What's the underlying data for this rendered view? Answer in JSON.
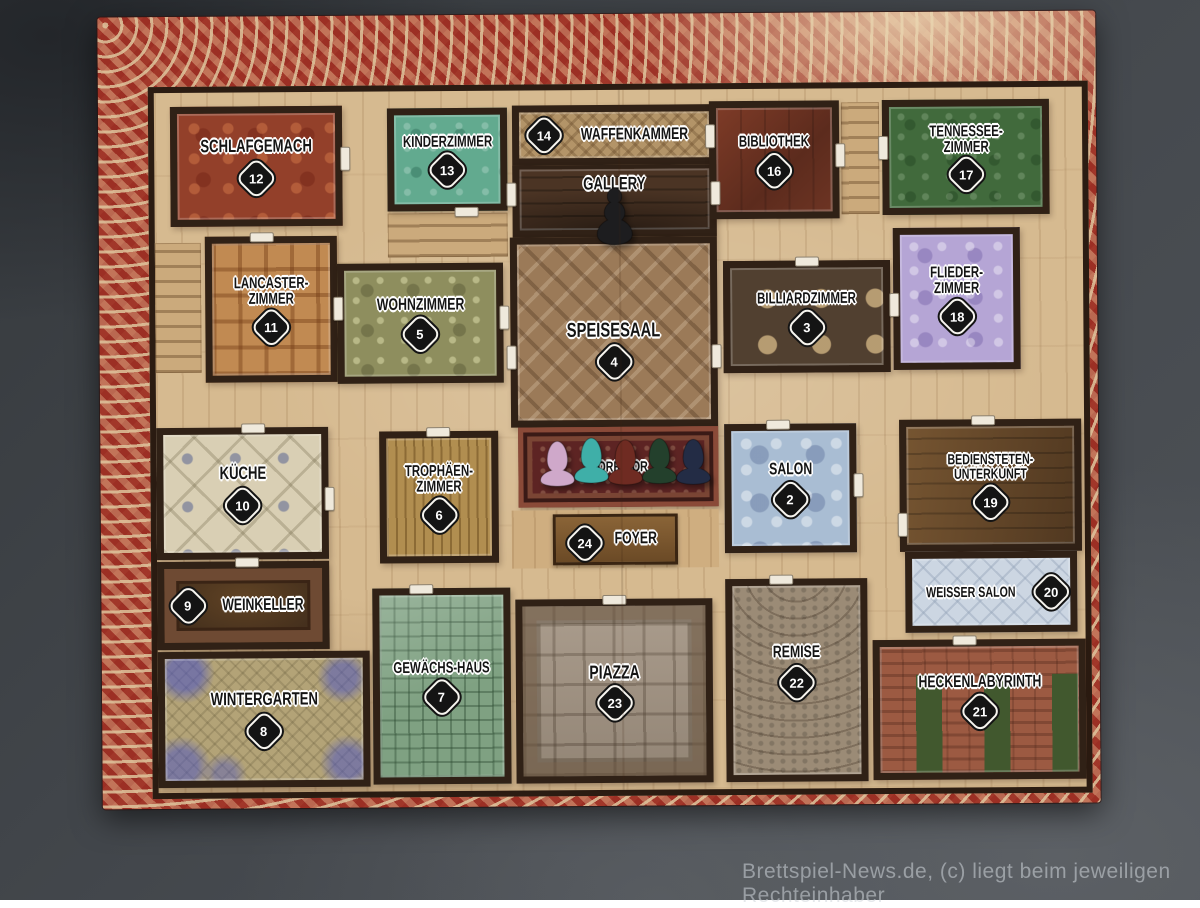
{
  "board": {
    "rooms": [
      {
        "key": "schlafgemach",
        "label": "Schlafgemach",
        "number": "12"
      },
      {
        "key": "kinderzimmer",
        "label": "Kinderzimmer",
        "number": "13"
      },
      {
        "key": "waffenkammer",
        "label": "Waffenkammer",
        "number": "14"
      },
      {
        "key": "gallery",
        "label": "Gallery",
        "number": ""
      },
      {
        "key": "bibliothek",
        "label": "Bibliothek",
        "number": "16"
      },
      {
        "key": "tennessee_zimmer",
        "label": "Tennessee-Zimmer",
        "number": "17"
      },
      {
        "key": "lancaster_zimmer",
        "label": "Lancaster-Zimmer",
        "number": "11"
      },
      {
        "key": "wohnzimmer",
        "label": "Wohnzimmer",
        "number": "5"
      },
      {
        "key": "speisesaal",
        "label": "Speisesaal",
        "number": "4"
      },
      {
        "key": "billiardzimmer",
        "label": "Billiardzimmer",
        "number": "3"
      },
      {
        "key": "flieder_zimmer",
        "label": "Flieder-Zimmer",
        "number": "18"
      },
      {
        "key": "kueche",
        "label": "Küche",
        "number": "10"
      },
      {
        "key": "trophaeen_zimmer",
        "label": "Trophäen-Zimmer",
        "number": "6"
      },
      {
        "key": "korridor",
        "label": "Korridor",
        "number": ""
      },
      {
        "key": "foyer",
        "label": "Foyer",
        "number": "24"
      },
      {
        "key": "salon",
        "label": "Salon",
        "number": "2"
      },
      {
        "key": "bediensteten_unterkunft",
        "label": "Bediensteten-Unterkunft",
        "number": "19"
      },
      {
        "key": "weinkeller",
        "label": "Weinkeller",
        "number": "9"
      },
      {
        "key": "weisser_salon",
        "label": "Weisser Salon",
        "number": "20"
      },
      {
        "key": "wintergarten",
        "label": "Wintergarten",
        "number": "8"
      },
      {
        "key": "gewaechshaus",
        "label": "Gewächs-Haus",
        "number": "7"
      },
      {
        "key": "piazza",
        "label": "Piazza",
        "number": "23"
      },
      {
        "key": "remise",
        "label": "Remise",
        "number": "22"
      },
      {
        "key": "heckenlabyrinth",
        "label": "Heckenlabyrinth",
        "number": "21"
      }
    ],
    "pawns": {
      "doctor": {
        "name": "black-pawn",
        "hex": "#1d1d1f"
      },
      "players": [
        {
          "name": "pink-pawn",
          "hex": "#cfa8ca"
        },
        {
          "name": "teal-pawn",
          "hex": "#3fafa8"
        },
        {
          "name": "dark-red-pawn",
          "hex": "#6f2b22"
        },
        {
          "name": "dark-green-pawn",
          "hex": "#23402c"
        },
        {
          "name": "navy-pawn",
          "hex": "#232c45"
        }
      ]
    }
  },
  "watermark": "Brettspiel-News.de, (c) liegt beim jeweiligen Rechteinhaber"
}
